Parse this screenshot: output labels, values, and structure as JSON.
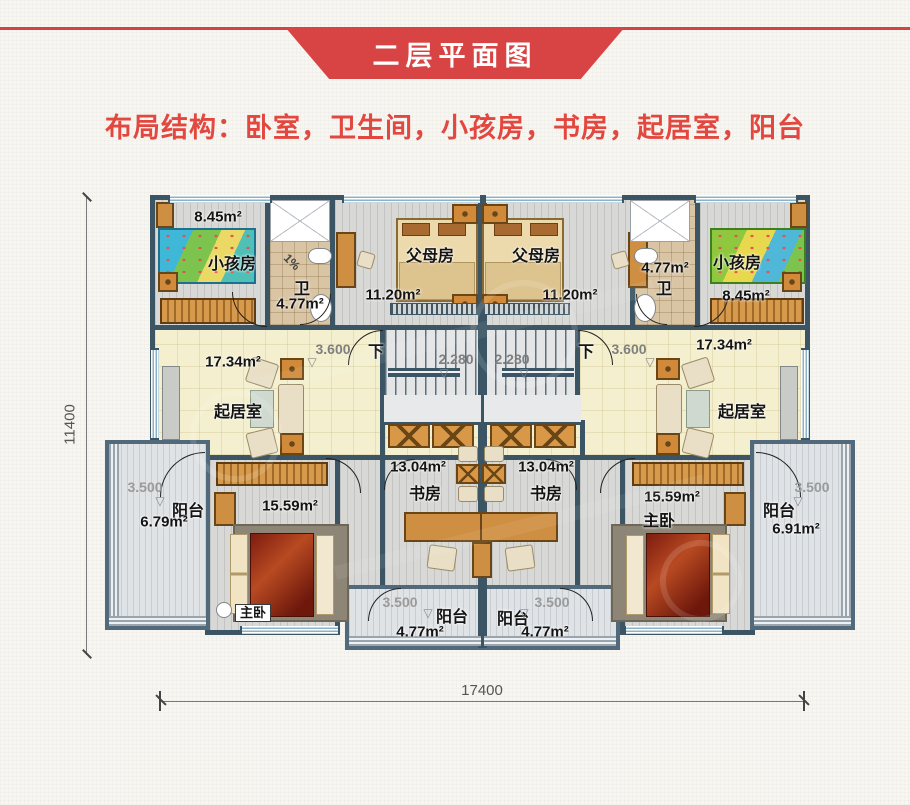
{
  "header": {
    "banner_title": "二层平面图",
    "subtitle": "布局结构：卧室，卫生间，小孩房，书房，起居室，阳台"
  },
  "colors": {
    "accent_red": "#d84343",
    "wall": "#3b5564",
    "living_floor": "#f4efcf"
  },
  "rooms": {
    "kids_left": {
      "name": "小孩房",
      "area": "8.45m²"
    },
    "bath_left": {
      "name": "卫",
      "area": "4.77m²"
    },
    "parents_left": {
      "name": "父母房",
      "area": "11.20m²"
    },
    "parents_right": {
      "name": "父母房",
      "area": "11.20m²"
    },
    "bath_right": {
      "name": "卫",
      "area": "4.77m²"
    },
    "kids_right": {
      "name": "小孩房",
      "area": "8.45m²"
    },
    "living_left": {
      "name": "起居室",
      "area": "17.34m²",
      "dim": "3.600"
    },
    "living_right": {
      "name": "起居室",
      "area": "17.34m²",
      "dim": "3.600"
    },
    "stair_left": {
      "dim": "2.280"
    },
    "stair_right": {
      "dim": "2.280"
    },
    "balcony_left": {
      "name": "阳台",
      "area": "6.79m²",
      "dim": "3.500"
    },
    "master_left": {
      "name": "主卧",
      "area": "15.59m²"
    },
    "study_left": {
      "name": "书房",
      "area": "13.04m²"
    },
    "study_right": {
      "name": "书房",
      "area": "13.04m²"
    },
    "master_right": {
      "name": "主卧",
      "area": "15.59m²"
    },
    "balcony_right": {
      "name": "阳台",
      "area": "6.91m²",
      "dim": "3.500"
    },
    "balcony_bottom_left": {
      "name": "阳台",
      "area": "4.77m²",
      "dim": "3.500"
    },
    "balcony_bottom_right": {
      "name": "阳台",
      "area": "4.77m²",
      "dim": "3.500"
    }
  },
  "dims": {
    "overall_width": "17400",
    "overall_height": "11400"
  },
  "markers": {
    "down": "下",
    "slope": "1%"
  }
}
